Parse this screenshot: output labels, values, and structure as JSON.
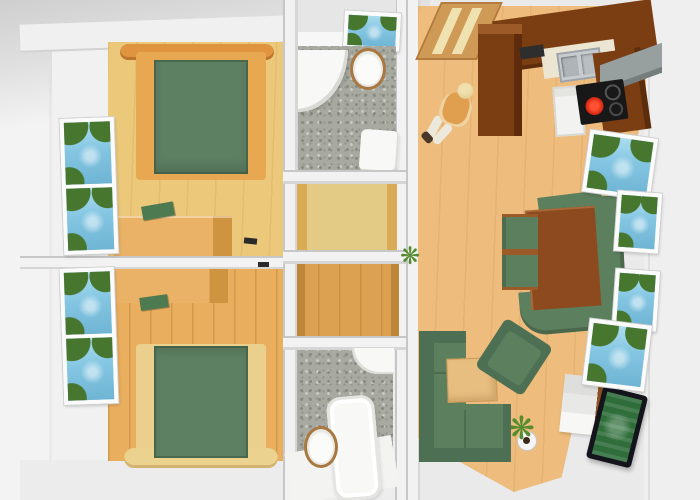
{
  "scene": {
    "description": "3D rendered top-down floor plan of a two-bedroom apartment with two bathrooms, two small hallways and a combined kitchen / living room",
    "view": "bird's-eye 3D render, no visible text",
    "colors": {
      "background": "#eaeaea",
      "wall_light": "#f2f2f2",
      "bedroom1_floor": "#ecc87b",
      "bedroom2_floor": "#e9ae5e",
      "bed_frame": "#e09440",
      "bed_frame_light": "#e8a851",
      "bed_foot_pale": "#ecd28f",
      "bed_cover": "#5d7f62",
      "dresser_wood": "#e9b267",
      "deco_green": "#4e7a52",
      "hall1_floor": "#e3cb85",
      "hall2_floor": "#dda251",
      "bath_floor": "#a8a9a0",
      "fixture_white": "#f8f8f6",
      "toilet_ring": "#a87840",
      "living_floor": "#eebc7c",
      "cabinet_brown": "#7b3d12",
      "cabinet_brown_light": "#9c5a28",
      "counter_light": "#ece5d2",
      "sink_steel": "#c6cbcf",
      "cooktop_black": "#181818",
      "burner_red": "#cf2312",
      "vent_gray": "#98a09f",
      "door_wood": "#cf9a55",
      "table_brown": "#8c4a1e",
      "sofa_green": "#5c7f5e",
      "sofa_green_dark": "#4d6f53",
      "tv_frame": "#14141c",
      "tv_screen": "#2f6d3a",
      "window_sky": "#84c6e2",
      "window_tree": "#47762f",
      "person_shirt": "#df9f4e",
      "person_hair": "#dcc382",
      "person_pants": "#ece8dc",
      "plant_green": "#568c30"
    },
    "icons": {
      "plant_glyph": "❋"
    }
  },
  "rooms": [
    {
      "name": "bedroom-1",
      "position": "top-left",
      "furniture": [
        "double bed with green cover and orange wood canopy",
        "wooden dresser with green decor item",
        "tall window with landscape view"
      ]
    },
    {
      "name": "bedroom-2",
      "position": "bottom-left",
      "furniture": [
        "double bed with green cover and pale wood footboard",
        "wooden dresser with green decor item",
        "tall window with landscape view"
      ]
    },
    {
      "name": "bathroom-1",
      "position": "top-center",
      "furniture": [
        "corner shower",
        "toilet",
        "washbasin",
        "small window with landscape view"
      ],
      "floor": "grey pebble tiles"
    },
    {
      "name": "hallway-1",
      "position": "center",
      "floor": "pale wood"
    },
    {
      "name": "hallway-2",
      "position": "center",
      "floor": "orange wood planks"
    },
    {
      "name": "bathroom-2",
      "position": "bottom-center",
      "furniture": [
        "bathtub",
        "toilet",
        "corner washbasin"
      ],
      "floor": "grey pebble tiles"
    },
    {
      "name": "living-room-kitchen",
      "position": "right",
      "furniture": [
        "entrance door",
        "L-shaped dark brown kitchen with sink, ceramic hob with red-hot burner and oven",
        "grey extractor chimney",
        "walking person figure",
        "dining table with green corner bench and two chairs",
        "green corner sofa",
        "green armchair",
        "light wood coffee table",
        "white sideboard",
        "television showing green pitch",
        "two potted plants",
        "four windows with landscape view"
      ]
    }
  ]
}
